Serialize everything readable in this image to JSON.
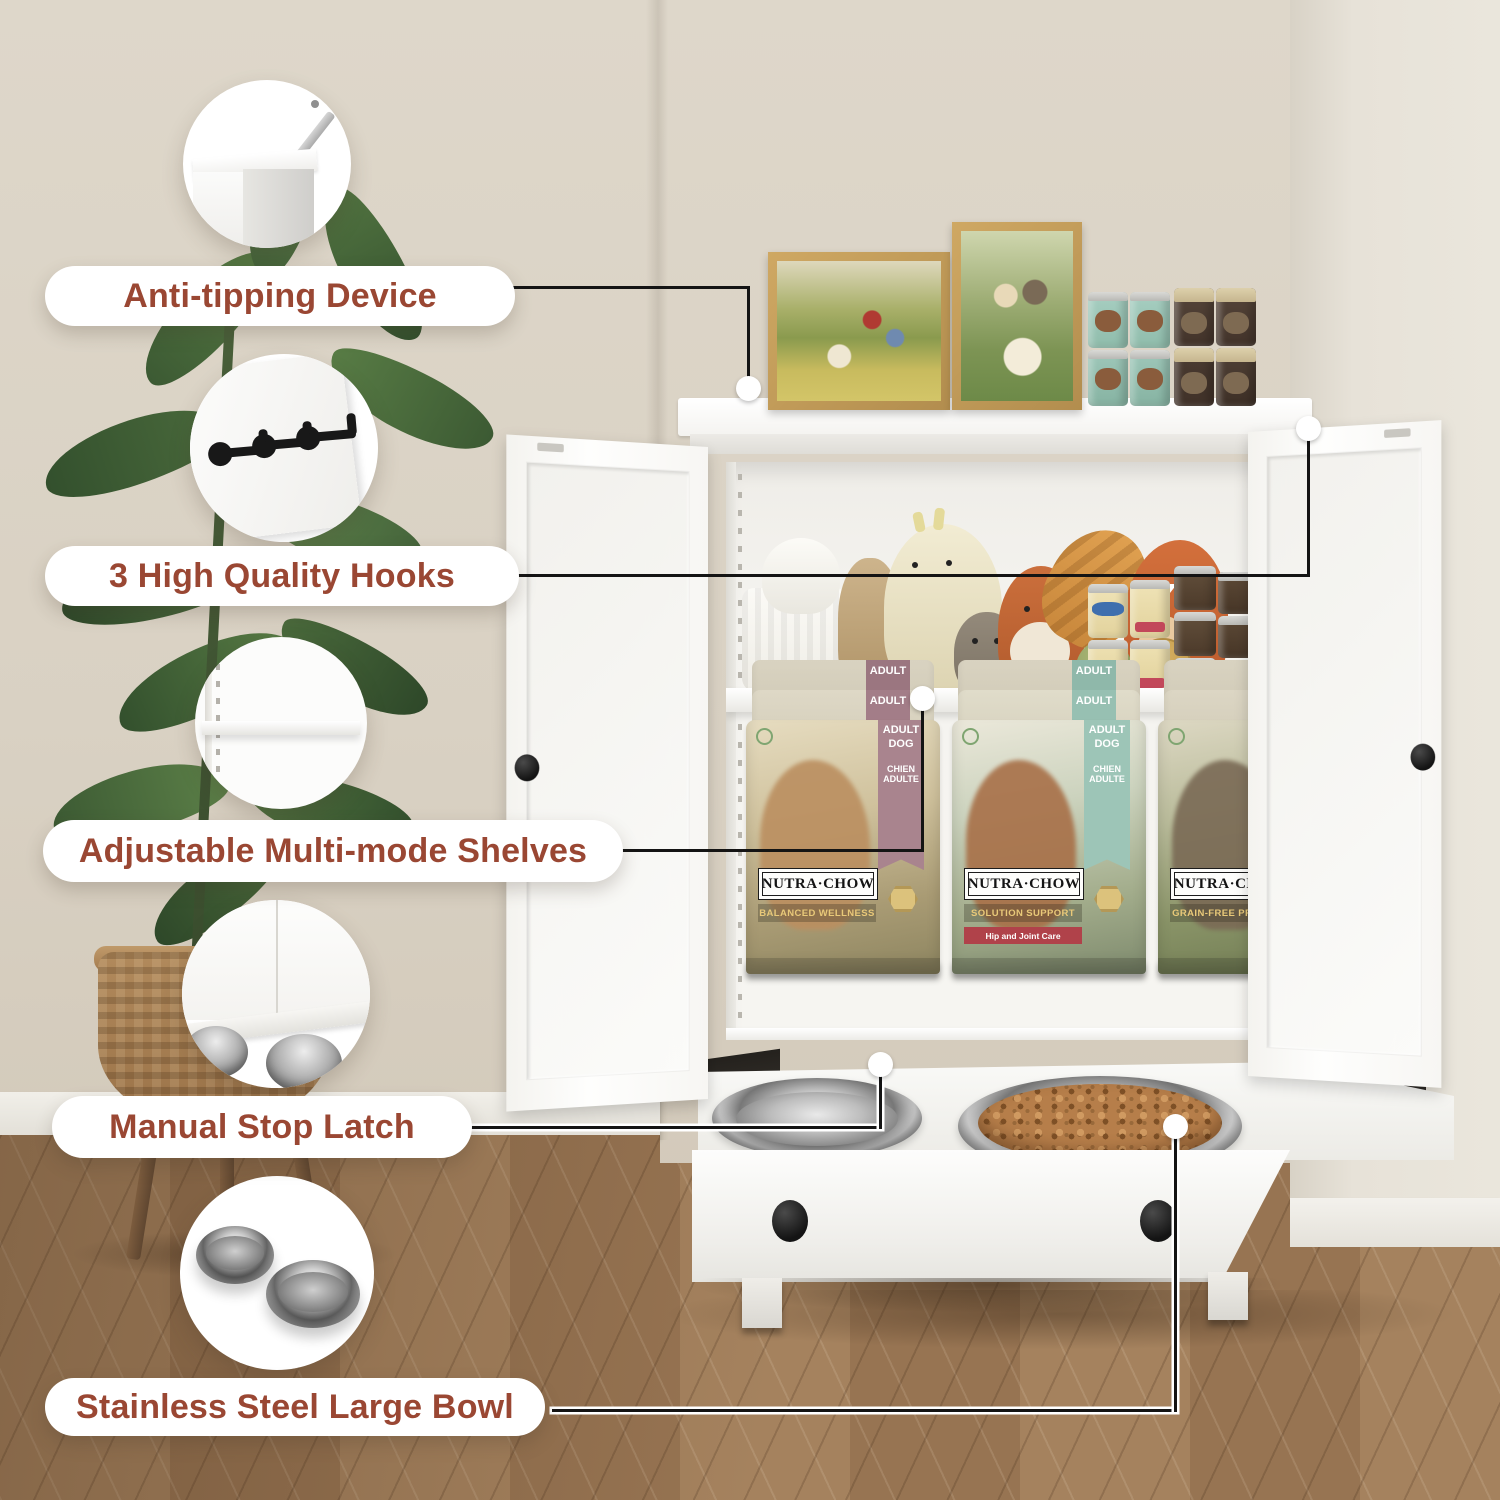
{
  "accent_text_color": "#9a4733",
  "callouts": [
    {
      "label": "Anti-tipping Device",
      "icon": "anti-tip-bracket-icon"
    },
    {
      "label": "3 High Quality Hooks",
      "icon": "wall-hooks-icon"
    },
    {
      "label": "Adjustable Multi-mode Shelves",
      "icon": "adjustable-shelf-icon"
    },
    {
      "label": "Manual Stop Latch",
      "icon": "stop-latch-icon"
    },
    {
      "label": "Stainless Steel Large Bowl",
      "icon": "steel-bowls-icon"
    }
  ],
  "product_graphics": {
    "dog_food_brand": "NUTRA·CHOW",
    "bags": [
      {
        "banner_line1": "ADULT",
        "banner_line2": "DOG",
        "banner_line3": "CHIEN",
        "banner_line4": "ADULTE",
        "variant": "BALANCED WELLNESS",
        "banner_color": "#a9848e"
      },
      {
        "banner_line1": "ADULT",
        "banner_line2": "DOG",
        "banner_line3": "CHIEN",
        "banner_line4": "ADULTE",
        "variant": "SOLUTION SUPPORT",
        "sub_label": "Hip and Joint Care",
        "banner_color": "#9dc5b7"
      },
      {
        "banner_line1": "ADULT",
        "banner_line2": "DOG",
        "banner_line3": "CHIEN",
        "banner_line4": "ADULTE",
        "variant": "GRAIN-FREE PREMIUM",
        "banner_color": "#948a80"
      }
    ]
  }
}
